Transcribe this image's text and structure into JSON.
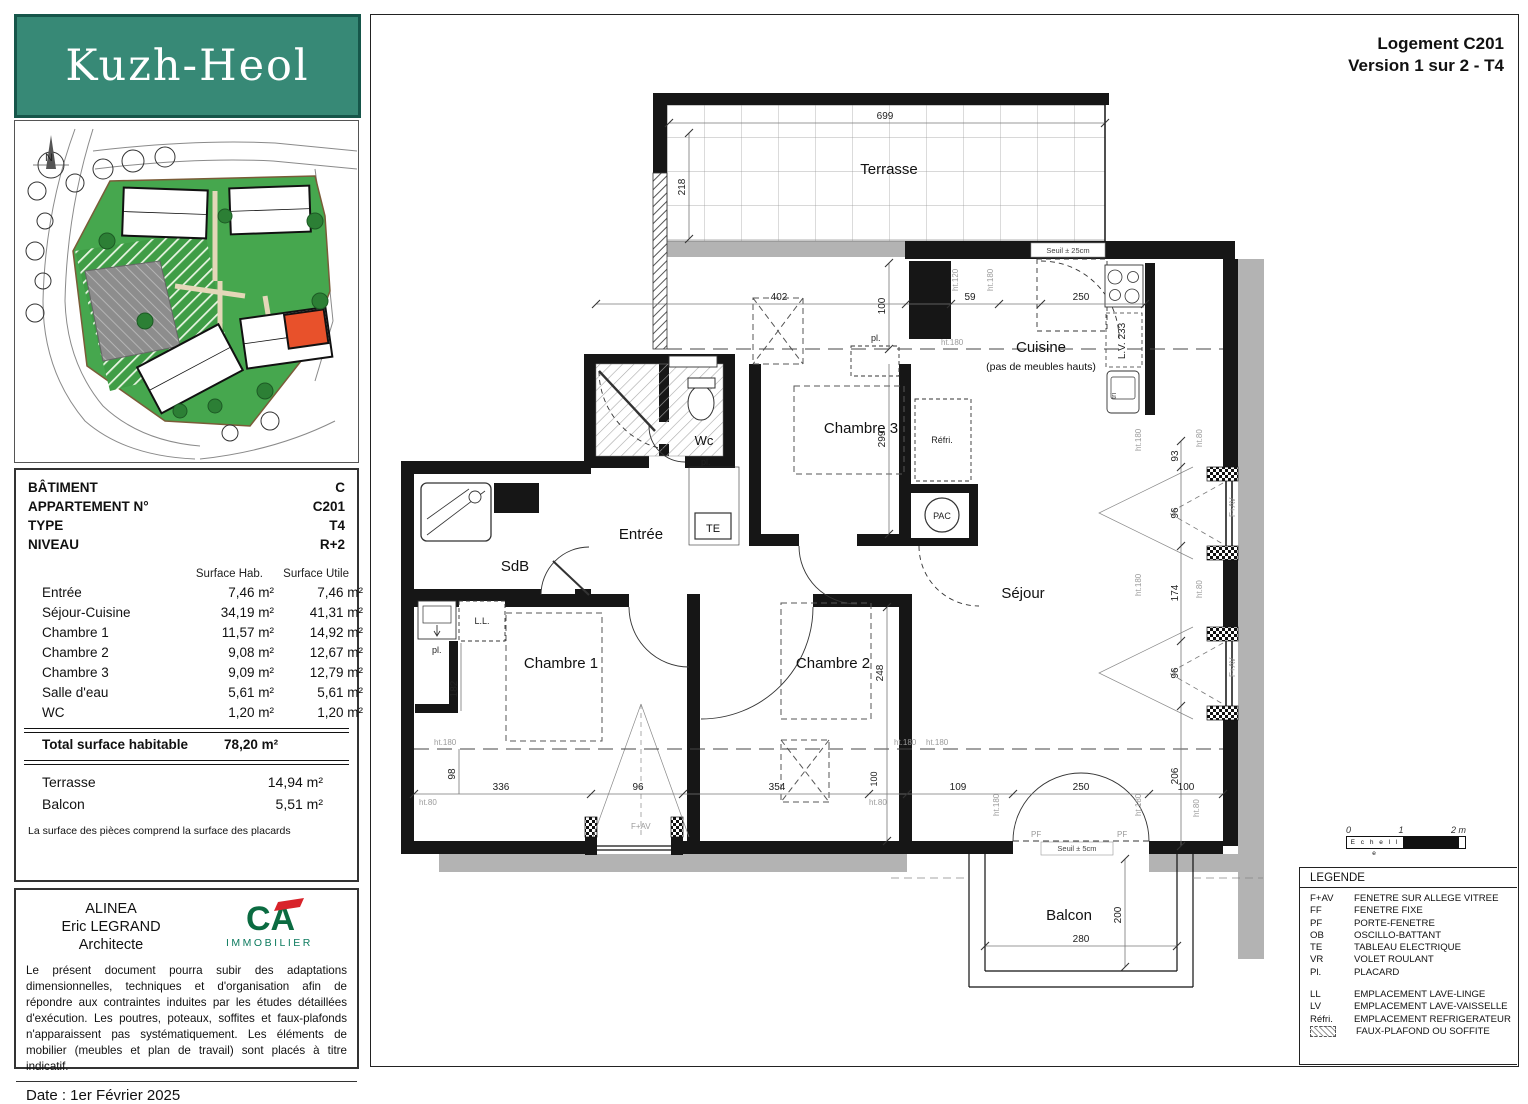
{
  "logo": {
    "text": "Kuzh-Heol"
  },
  "title": {
    "line1": "Logement C201",
    "line2": "Version 1 sur 2 - T4"
  },
  "info": {
    "rows": [
      {
        "label": "BÂTIMENT",
        "value": "C"
      },
      {
        "label": "APPARTEMENT N°",
        "value": "C201"
      },
      {
        "label": "TYPE",
        "value": "T4"
      },
      {
        "label": "NIVEAU",
        "value": "R+2"
      }
    ]
  },
  "surfaces": {
    "col_hab": "Surface Hab.",
    "col_utile": "Surface Utile",
    "rows": [
      {
        "name": "Entrée",
        "hab": "7,46  m²",
        "utile": "7,46  m²"
      },
      {
        "name": "Séjour-Cuisine",
        "hab": "34,19  m²",
        "utile": "41,31  m²"
      },
      {
        "name": "Chambre 1",
        "hab": "11,57  m²",
        "utile": "14,92  m²"
      },
      {
        "name": "Chambre 2",
        "hab": "9,08  m²",
        "utile": "12,67  m²"
      },
      {
        "name": "Chambre 3",
        "hab": "9,09  m²",
        "utile": "12,79  m²"
      },
      {
        "name": "Salle d'eau",
        "hab": "5,61  m²",
        "utile": "5,61  m²"
      },
      {
        "name": "WC",
        "hab": "1,20  m²",
        "utile": "1,20  m²"
      }
    ],
    "total_label": "Total surface habitable",
    "total_value": "78,20  m²",
    "annexes": [
      {
        "name": "Terrasse",
        "value": "14,94  m²"
      },
      {
        "name": "Balcon",
        "value": "5,51  m²"
      }
    ],
    "note": "La surface des pièces comprend la surface des placards"
  },
  "architect": {
    "line1": "ALINEA",
    "line2": "Eric LEGRAND",
    "line3": "Architecte",
    "ca_letters": "CA",
    "ca_sub": "IMMOBILIER"
  },
  "disclaimer": "Le présent document pourra subir des adaptations dimensionnelles, techniques et d'organisation afin de répondre aux contraintes induites par les études détaillées d'exécution. Les poutres, poteaux, soffites et faux-plafonds n'apparaissent pas systématiquement. Les éléments de mobilier (meubles et plan de travail) sont placés à titre indicatif.",
  "date": "Date : 1er Février 2025",
  "scale": {
    "t0": "0",
    "t1": "1",
    "t2": "2 m",
    "label": "E c h e l l e"
  },
  "legend": {
    "title": "LEGENDE",
    "group1": [
      {
        "code": "F+AV",
        "label": "FENETRE SUR ALLEGE VITREE"
      },
      {
        "code": "FF",
        "label": "FENETRE FIXE"
      },
      {
        "code": "PF",
        "label": "PORTE-FENETRE"
      },
      {
        "code": "OB",
        "label": "OSCILLO-BATTANT"
      },
      {
        "code": "TE",
        "label": "TABLEAU ELECTRIQUE"
      },
      {
        "code": "VR",
        "label": "VOLET ROULANT"
      },
      {
        "code": "Pl.",
        "label": "PLACARD"
      }
    ],
    "group2": [
      {
        "code": "LL",
        "label": "EMPLACEMENT LAVE-LINGE"
      },
      {
        "code": "LV",
        "label": "EMPLACEMENT LAVE-VAISSELLE"
      },
      {
        "code": "Réfri.",
        "label": "EMPLACEMENT REFRIGERATEUR"
      }
    ],
    "soffite_label": "FAUX-PLAFOND OU SOFFITE"
  },
  "plan": {
    "rooms": {
      "terrasse": "Terrasse",
      "cuisine": "Cuisine",
      "cuisine_note": "(pas de meubles hauts)",
      "chambre3": "Chambre 3",
      "chambre1": "Chambre 1",
      "chambre2": "Chambre 2",
      "sejour": "Séjour",
      "sdb": "SdB",
      "entree": "Entrée",
      "wc": "Wc",
      "balcon": "Balcon"
    },
    "fixtures": {
      "ll": "L.L.",
      "lv233": "L.V.  233",
      "refri": "Réfri.",
      "pl": "pl.",
      "tri": "tri",
      "te": "TE",
      "pac": "PAC"
    },
    "seuils": {
      "terrasse": "Seuil ± 25cm",
      "balcon": "Seuil ± 5cm"
    },
    "codes": {
      "fav": "F+AV",
      "pf": "PF"
    },
    "heights": {
      "ht180": "ht.180",
      "ht80": "ht.80",
      "ht120": "ht.120"
    },
    "dims": {
      "d699": "699",
      "d218": "218",
      "d402": "402",
      "d59": "59",
      "d250": "250",
      "d100": "100",
      "d299": "299",
      "d93": "93",
      "d96": "96",
      "d174": "174",
      "d206": "206",
      "d248": "248",
      "d98": "98",
      "d336": "336",
      "d354": "354",
      "d109": "109",
      "d182": "182",
      "d280": "280",
      "d200": "200"
    },
    "compass": "N"
  }
}
